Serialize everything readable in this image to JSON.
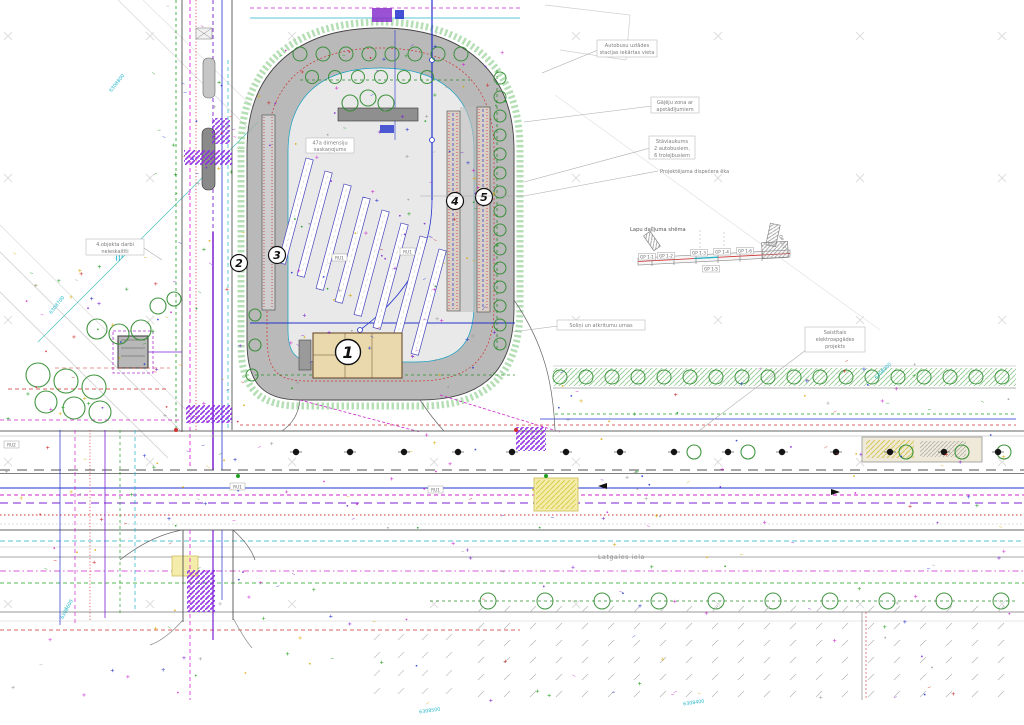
{
  "title": "Autoostas un Latgales ielas labiekārtojuma plāns",
  "callouts": {
    "charging": [
      "Autobusu uzlādes",
      "stacijas iekārtas vieta"
    ],
    "ped_zone": [
      "Gājēju zona ar",
      "apstādījumiem"
    ],
    "parking": [
      "Stāvlaukums",
      "2 autobusiem,",
      "6 trolejbusiem"
    ],
    "dispatcher": "Projektējama dispečera ēka",
    "object4": [
      "4.objekta darbi",
      "neieskaitīti"
    ],
    "note47a": [
      "47a dimensiju",
      "saskaņojums"
    ],
    "benches": "Soliņi un atkritumu urnas",
    "electric": [
      "Saistītais",
      "elektroapgādes",
      "projekts"
    ]
  },
  "streets": {
    "main": "Latgales iela"
  },
  "stops": [
    "1",
    "2",
    "3",
    "4",
    "5"
  ],
  "scheme": {
    "title": "Lapu dalījuma shēma",
    "segments": [
      "GP 1-1",
      "GP 1-2",
      "GP 1-3",
      "GP 1-4",
      "GP 1-5",
      "GP 1-6",
      "GP 1-7"
    ]
  },
  "ref_labels": [
    "RU2",
    "RU1",
    "RU1",
    "RU1",
    "RU1"
  ],
  "coords": [
    "6308800",
    "6308700",
    "6308600",
    "6308900",
    "6308500",
    "6308400"
  ],
  "colors": {
    "road_gray": "#a8a8a8",
    "apron_gray": "#e9e9e9",
    "building_tan": "#ead9ad",
    "crosswalk_purple": "#8a2be2",
    "utility_magenta": "#cc22cc",
    "utility_blue": "#2233cc",
    "utility_red": "#cc2222",
    "landscape_green": "#2e8b2e",
    "coord_cyan": "#19b4c8",
    "highlight_yellow": "#f3ecab"
  }
}
